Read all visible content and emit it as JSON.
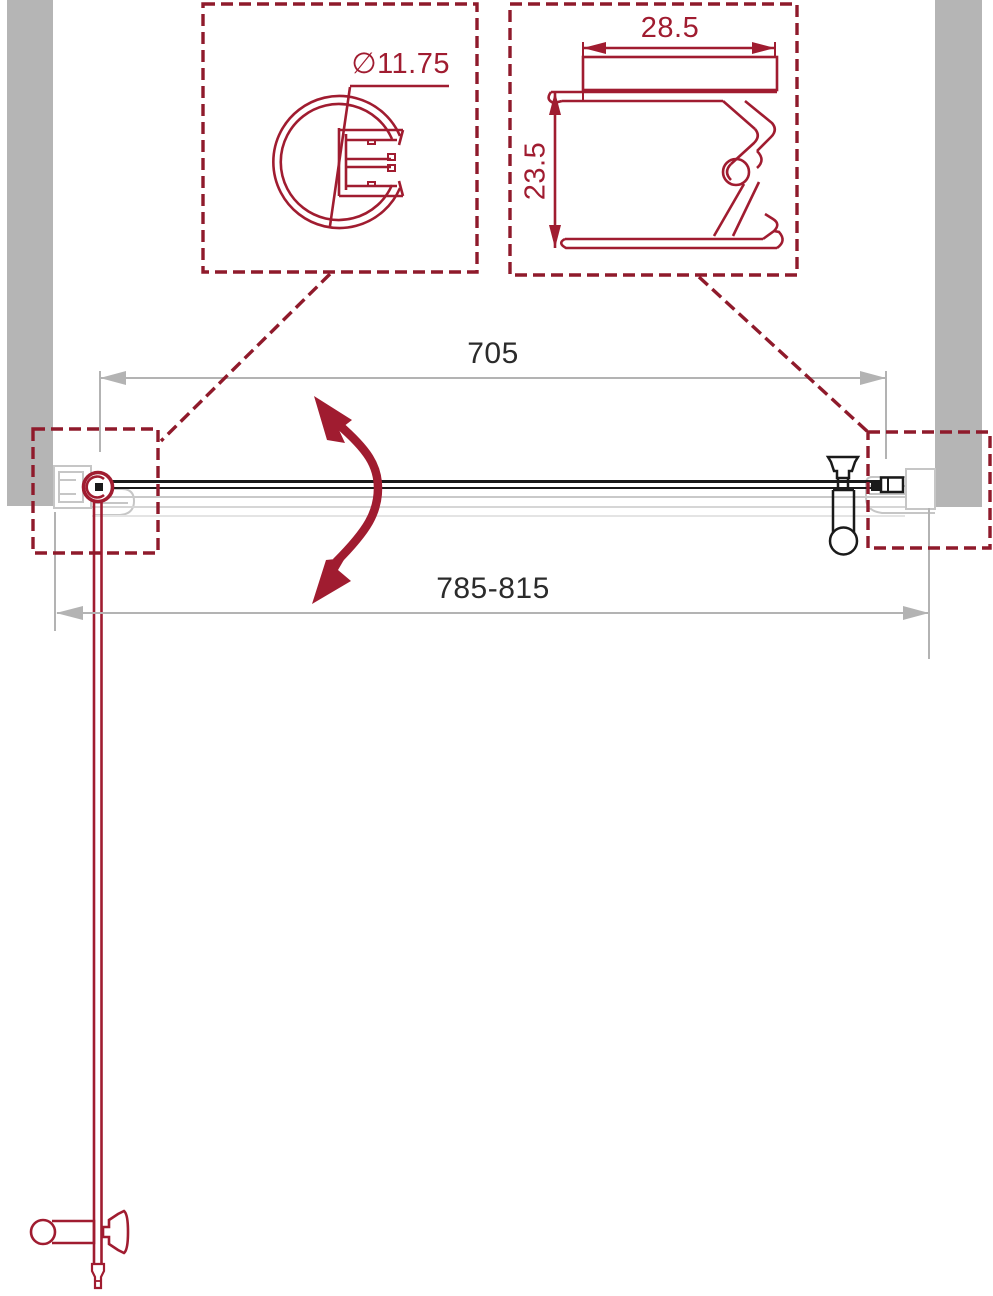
{
  "drawing": {
    "type": "technical-installation-diagram",
    "labels": {
      "glass_width": "705",
      "overall_width": "785-815",
      "profile_diameter": "∅11.75",
      "wall_profile_width": "28.5",
      "wall_profile_depth": "23.5"
    },
    "colors": {
      "accent_red": "#A01C30",
      "callout_red": "#8F1A2B",
      "line_black": "#1a1a1a",
      "wall_gray": "#b5b5b5",
      "dim_gray": "#b3b3b3",
      "ghost_gray": "#d0d0d0",
      "text_dark": "#2b2b2b"
    }
  }
}
